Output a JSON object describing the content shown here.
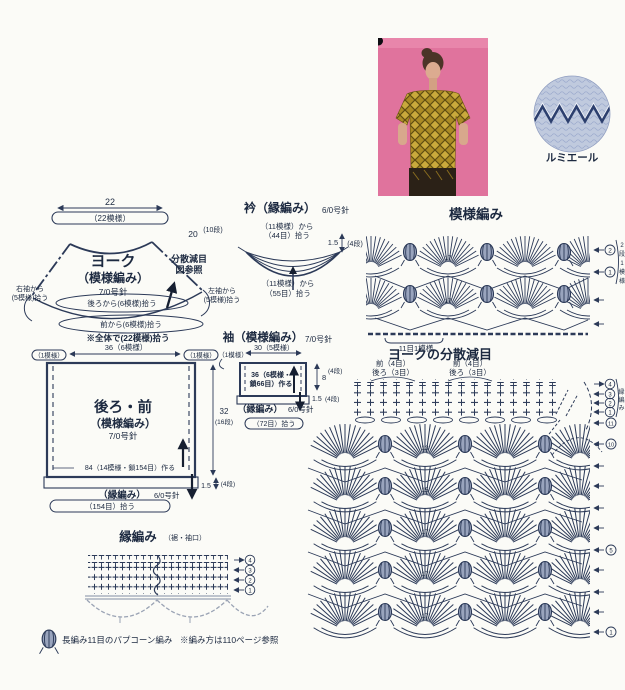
{
  "colors": {
    "ink": "#2c3a58",
    "gray": "#9aa3b4",
    "pink": "#e0739d",
    "gold": "#ab8b25",
    "swatch_blue": "#c0cade",
    "zigzag_navy": "#2c3f6e"
  },
  "swatch": {
    "label": "ルミエール"
  },
  "yoke": {
    "title": "ヨーク",
    "subtitle": "（模様編み）",
    "hook": "7/0号針",
    "top_width": "22",
    "top_pattern": "（22模様）",
    "rows": "20",
    "rows_paren": "(10段)",
    "dec1": "分散減目",
    "dec2": "図参照",
    "left1": "右袖から",
    "left2": "(5模様)拾う",
    "right1": "左袖から",
    "right2": "(5模様)拾う",
    "back": "後ろから(6模様)拾う",
    "front": "前から(6模様)拾う",
    "total": "※全体で(22模様)拾う"
  },
  "collar": {
    "title": "衿（縁編み）",
    "hook": "6/0号針",
    "top1": "（11模様）から",
    "top2": "（44目）拾う",
    "height": "1.5",
    "height_rows": "(4段)",
    "bottom1": "（11模様）から",
    "bottom2": "（55目）拾う"
  },
  "sleeve": {
    "title": "袖（模様編み）",
    "hook": "7/0号針",
    "one_pattern": "（1模様）",
    "top": "30（5模様）",
    "cast1": "36（6模様・",
    "cast2": "鎖66目）作る",
    "body_h": "8",
    "body_rows": "(4段)",
    "cuff_h": "1.5",
    "cuff_rows": "(4段)",
    "edge": "（縁編み）",
    "edge_hook": "6/0号針",
    "pick": "（72目）拾う"
  },
  "body": {
    "title": "後ろ・前",
    "subtitle": "（模様編み）",
    "hook": "7/0号針",
    "one_left": "（1模様）",
    "one_right": "（1模様）",
    "top": "36（6模様）",
    "height": "32",
    "height_rows": "(16段)",
    "cast": "84（14模様・鎖154目）作る",
    "edge": "（縁編み）",
    "edge_hook": "6/0号針",
    "cuff_h": "1.5",
    "cuff_rows": "(4段)",
    "pick": "（154目）拾う"
  },
  "pattern_chart": {
    "title": "模様編み",
    "fans": [
      "17",
      "17"
    ],
    "row2": "2",
    "row1": "1",
    "repeat": [
      "2",
      "段",
      "1",
      "模",
      "様"
    ],
    "base": "11目1模様"
  },
  "decrease_chart": {
    "title": "ヨークの分散減目",
    "front": "前（4目）",
    "back": "後ろ（3目）",
    "edge_rows": [
      "4",
      "3",
      "2",
      "1"
    ],
    "edge_label": [
      "縁",
      "編",
      "み"
    ],
    "r11": "11",
    "r10": "10",
    "r5": "5",
    "r1": "1",
    "fans": [
      "13",
      "15",
      "17",
      "17",
      "17"
    ]
  },
  "edging_chart": {
    "title": "縁編み",
    "subtitle": "（裾・袖口）",
    "rows": [
      "4",
      "3",
      "2",
      "1"
    ]
  },
  "legend": {
    "t1": "長編み11目のパプコーン編み",
    "t2": "※編み方は110ページ参照"
  }
}
